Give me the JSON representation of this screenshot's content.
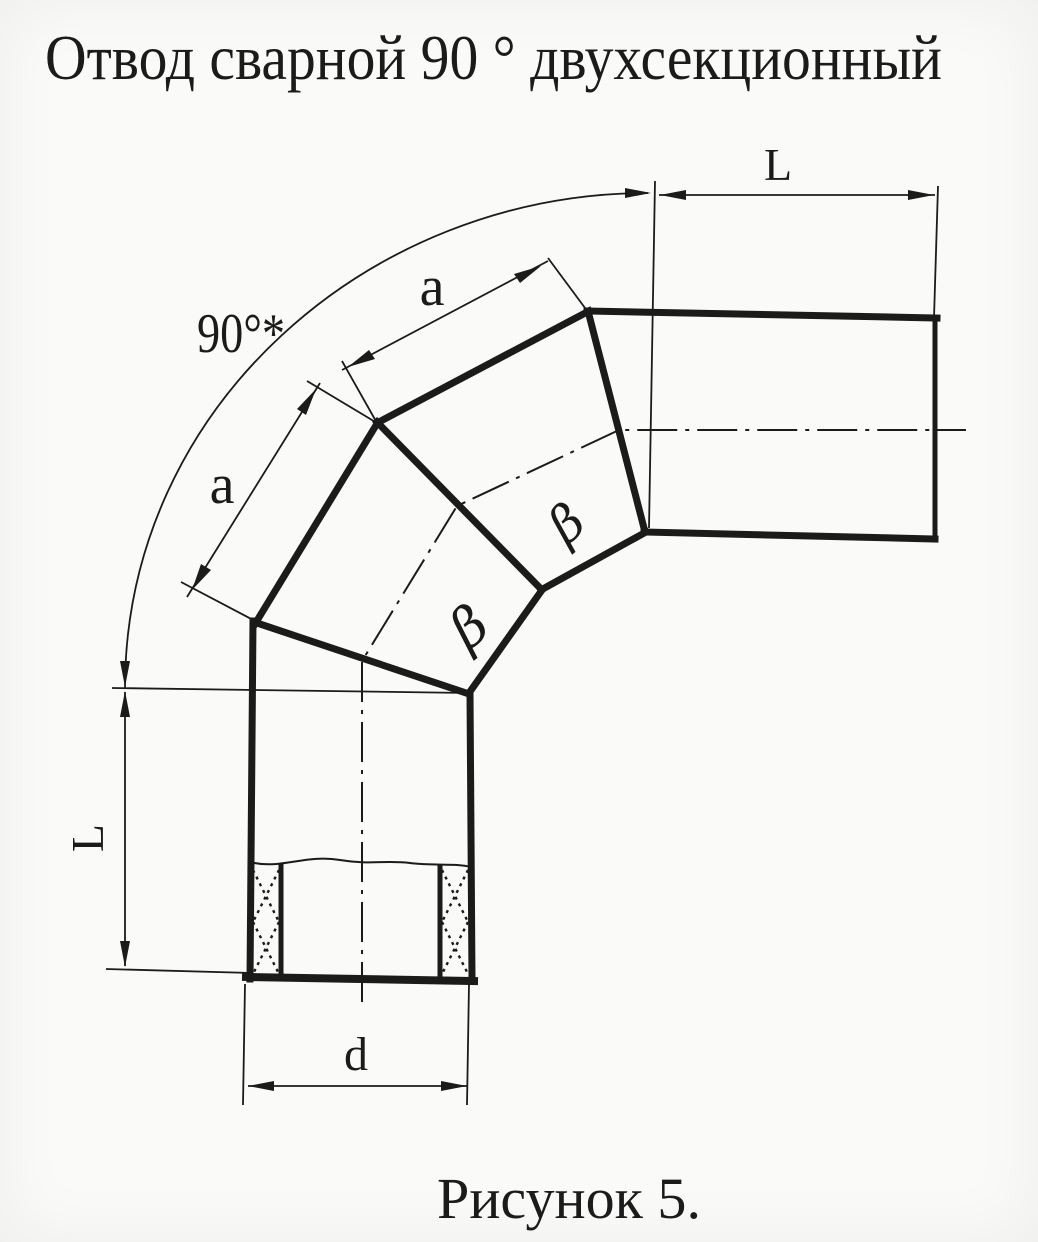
{
  "title": "Отвод сварной 90 ° двухсекционный",
  "caption": "Рисунок 5.",
  "labels": {
    "angle": "90°*",
    "length_top": "L",
    "length_left": "L",
    "segment_upper": "a",
    "segment_lower": "a",
    "diameter": "d",
    "bevel_upper": "β",
    "bevel_lower": "β"
  },
  "colors": {
    "ink": "#1b1b1b",
    "paper": "#fafaf8"
  }
}
